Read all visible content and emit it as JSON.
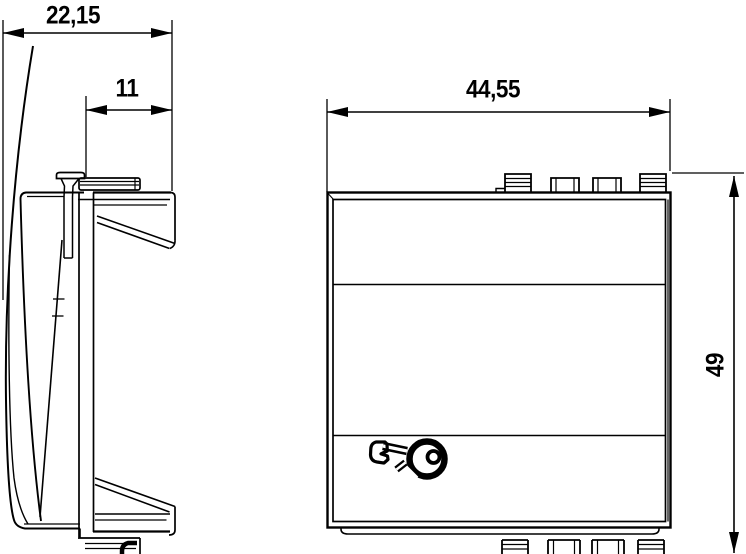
{
  "drawing": {
    "type": "technical-dimension-drawing",
    "colors": {
      "line": "#000000",
      "background": "#ffffff"
    },
    "dimensions": {
      "side_width": "22,15",
      "side_inner_width": "11",
      "front_width": "44,55",
      "front_height": "49"
    },
    "icons": {
      "front_symbol": "key-icon"
    }
  }
}
